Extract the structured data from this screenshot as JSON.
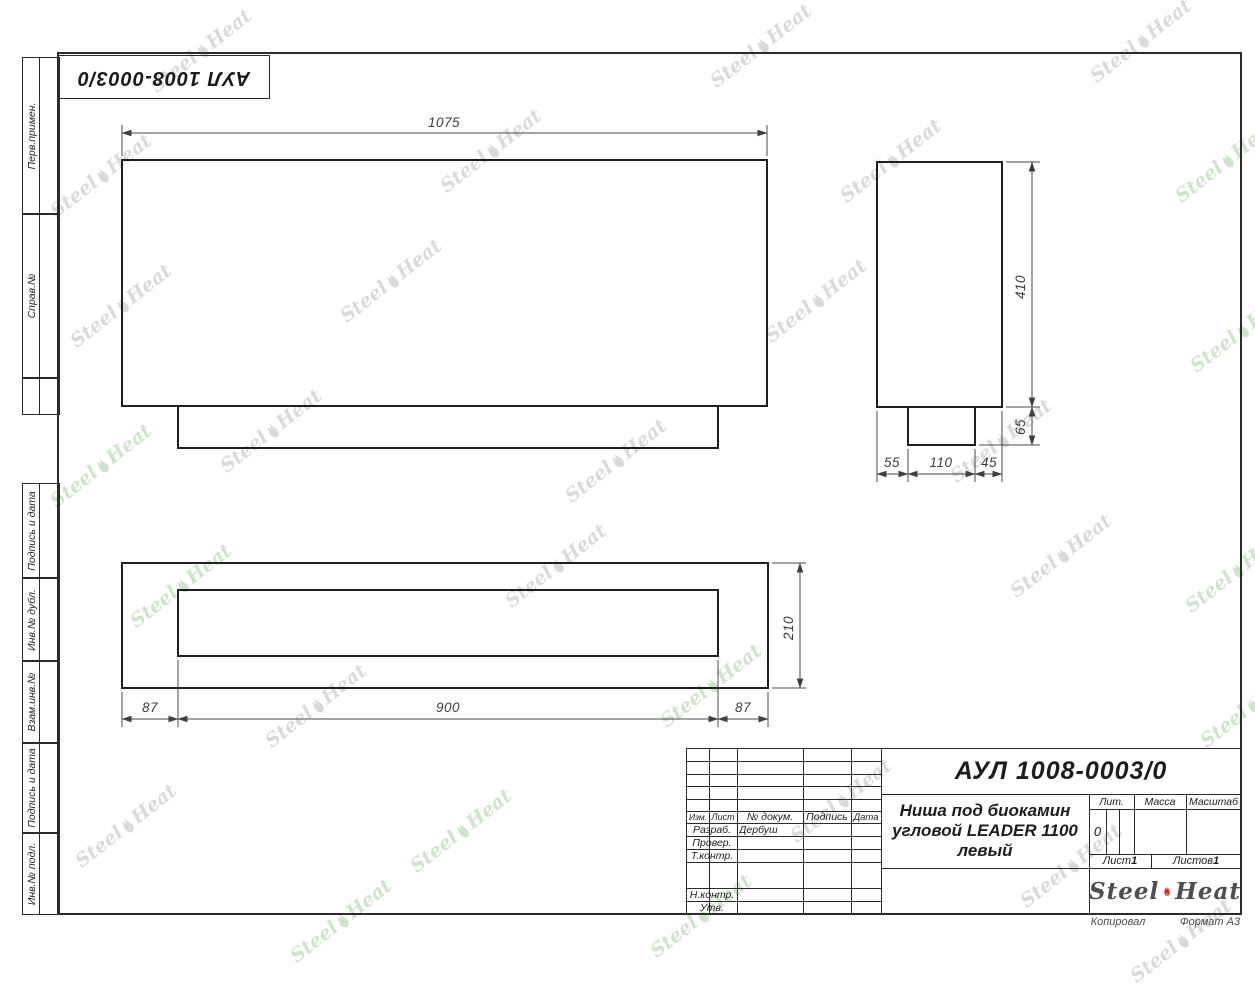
{
  "stamp": {
    "number": "АУЛ 1008-0003/0"
  },
  "side_panel": {
    "labels": [
      "Перв.примен.",
      "Справ.№",
      "Подпись и дата",
      "Инв.№ дубл.",
      "Взам.инв.№",
      "Подпись и дата",
      "Инв.№ подл."
    ]
  },
  "dims": {
    "front_width": "1075",
    "side_height": "410",
    "side_base_height": "65",
    "side_left": "55",
    "side_mid": "110",
    "side_right": "45",
    "plan_height": "210",
    "plan_left": "87",
    "plan_mid": "900",
    "plan_right": "87"
  },
  "title_block": {
    "doc_number": "АУЛ 1008-0003/0",
    "name_line1": "Ниша под биокамин",
    "name_line2": "угловой LEADER 1100",
    "name_line3": "левый",
    "col_izm": "Изм.",
    "col_list": "Лист",
    "col_dokum": "№ докум.",
    "col_podpis": "Подпись",
    "col_data": "Дата",
    "row_razrab": "Разраб.",
    "razrab_name": "Дербуш",
    "row_prover": "Провер.",
    "row_tkontr": "Т.контр.",
    "row_nkontr": "Н.контр.",
    "row_utv": "Утв.",
    "lit_label": "Лит.",
    "lit_value": "0",
    "massa_label": "Масса",
    "masshtab_label": "Масштаб",
    "list_label": "Лист",
    "list_value": "1",
    "listov_label": "Листов",
    "listov_value": "1",
    "logo_steel": "Steel",
    "logo_heat": "Heat",
    "kopiroval": "Копировал",
    "format": "Формат А3"
  },
  "watermark": {
    "steel": "Steel",
    "heat": "Heat"
  }
}
